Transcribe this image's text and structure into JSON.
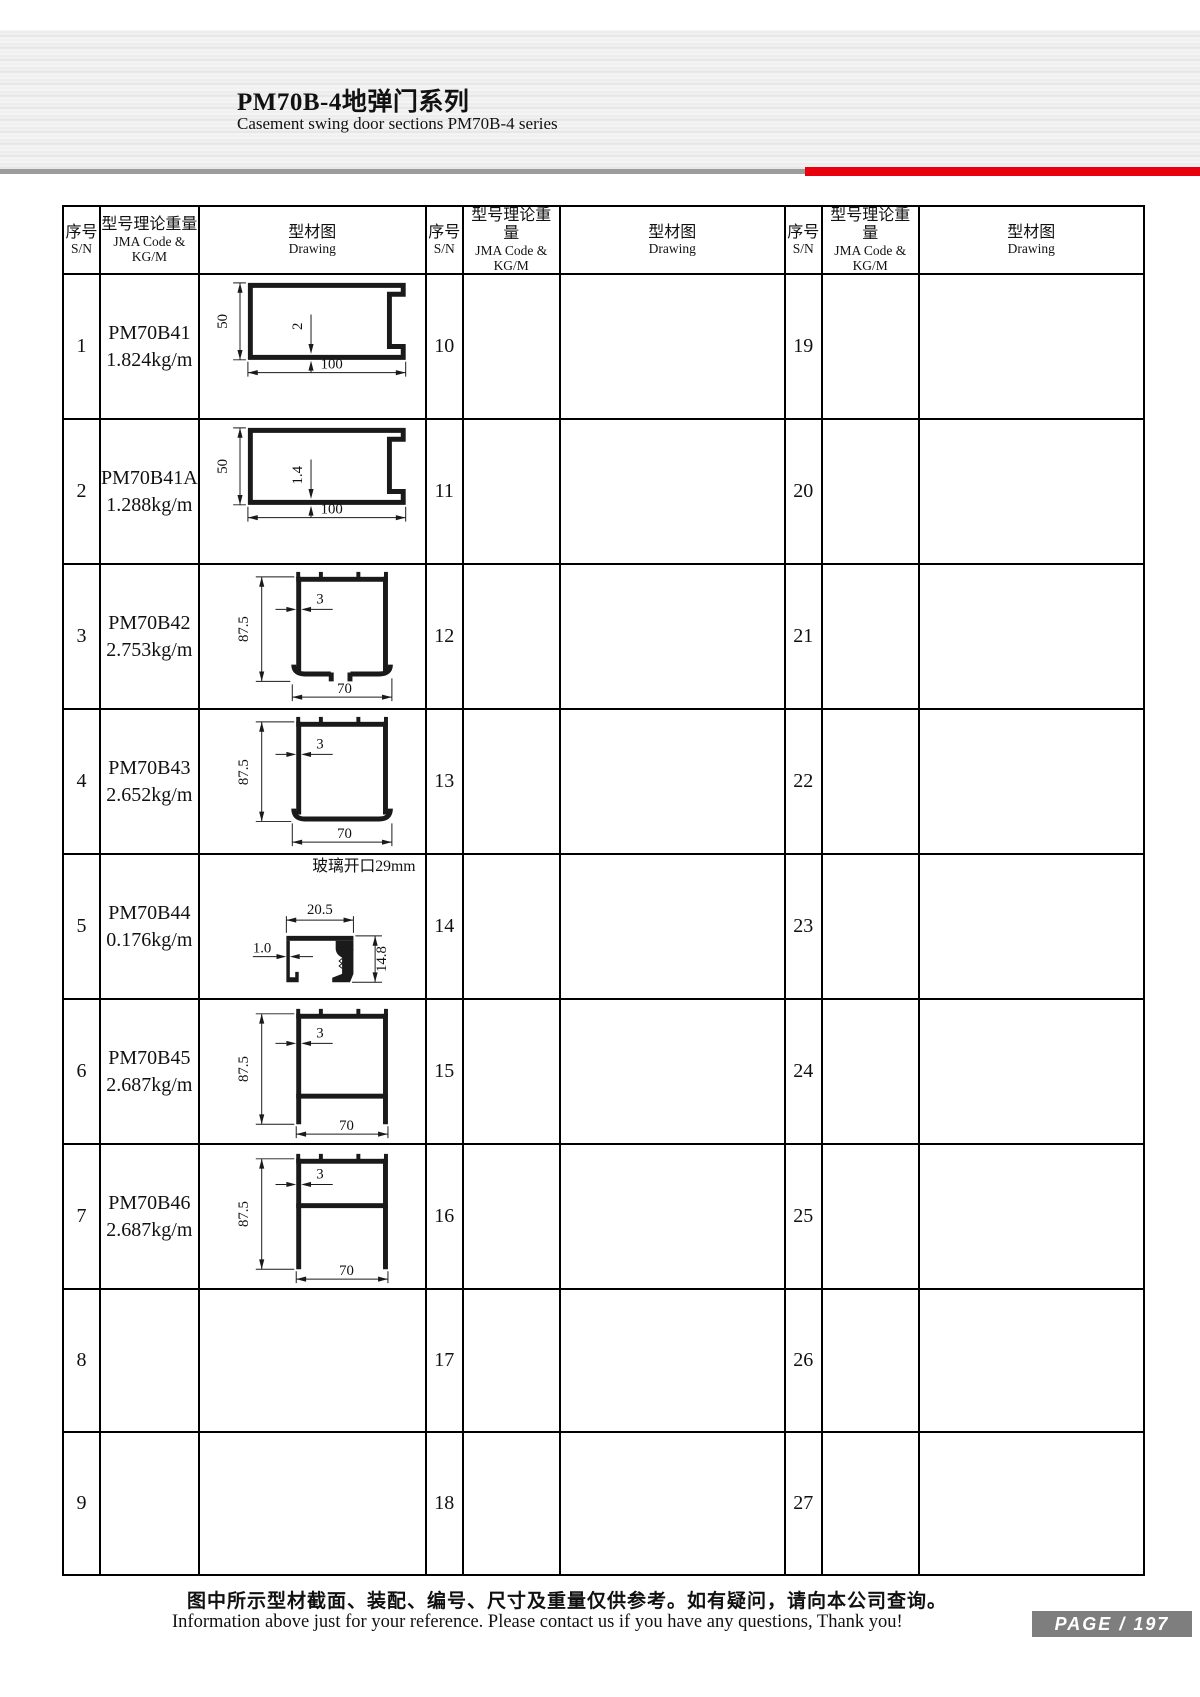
{
  "header": {
    "title": "PM70B-4地弹门系列",
    "subtitle": "Casement swing door sections PM70B-4 series"
  },
  "table": {
    "head": {
      "sn_zh": "序号",
      "sn_en": "S/N",
      "code_zh": "型号理论重量",
      "code_en": "JMA Code & KG/M",
      "draw_zh": "型材图",
      "draw_en": "Drawing"
    },
    "rows": [
      {
        "sn_a": "1",
        "code_a": "PM70B41",
        "wt_a": "1.824kg/m",
        "sn_b": "10",
        "sn_c": "19"
      },
      {
        "sn_a": "2",
        "code_a": "PM70B41A",
        "wt_a": "1.288kg/m",
        "sn_b": "11",
        "sn_c": "20"
      },
      {
        "sn_a": "3",
        "code_a": "PM70B42",
        "wt_a": "2.753kg/m",
        "sn_b": "12",
        "sn_c": "21"
      },
      {
        "sn_a": "4",
        "code_a": "PM70B43",
        "wt_a": "2.652kg/m",
        "sn_b": "13",
        "sn_c": "22"
      },
      {
        "sn_a": "5",
        "code_a": "PM70B44",
        "wt_a": "0.176kg/m",
        "sn_b": "14",
        "sn_c": "23"
      },
      {
        "sn_a": "6",
        "code_a": "PM70B45",
        "wt_a": "2.687kg/m",
        "sn_b": "15",
        "sn_c": "24"
      },
      {
        "sn_a": "7",
        "code_a": "PM70B46",
        "wt_a": "2.687kg/m",
        "sn_b": "16",
        "sn_c": "25"
      },
      {
        "sn_a": "8",
        "sn_b": "17",
        "sn_c": "26"
      },
      {
        "sn_a": "9",
        "sn_b": "18",
        "sn_c": "27"
      }
    ]
  },
  "drawings": {
    "p1": {
      "height": "50",
      "thickness": "2",
      "width": "100"
    },
    "p2": {
      "height": "50",
      "thickness": "1.4",
      "width": "100"
    },
    "p3": {
      "height": "87.5",
      "thickness": "3",
      "width": "70"
    },
    "p4": {
      "height": "87.5",
      "thickness": "3",
      "width": "70"
    },
    "p5": {
      "note": "玻璃开口29mm",
      "width": "20.5",
      "thickness": "1.0",
      "height": "14.8"
    },
    "p6": {
      "height": "87.5",
      "thickness": "3",
      "width": "70"
    },
    "p7": {
      "height": "87.5",
      "thickness": "3",
      "width": "70"
    }
  },
  "footer": {
    "note_zh": "图中所示型材截面、装配、编号、尺寸及重量仅供参考。如有疑问，请向本公司查询。",
    "note_en": "Information above just for your reference. Please contact us if you have any questions, Thank you!",
    "page_label": "PAGE / 197"
  }
}
